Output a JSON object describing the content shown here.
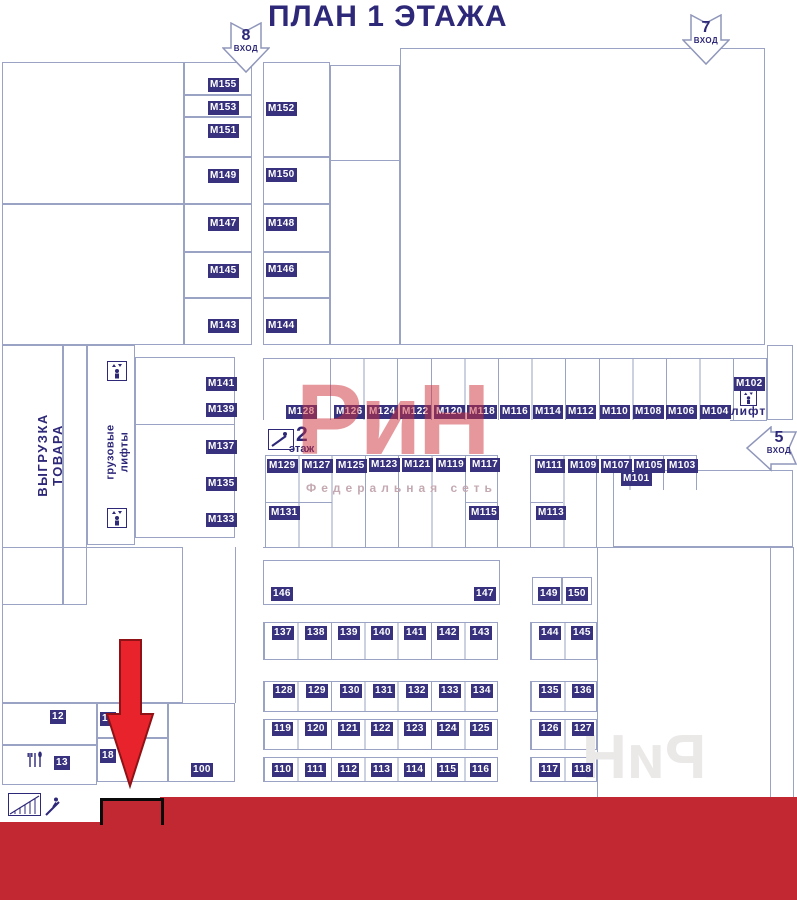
{
  "title": "ПЛАН 1 ЭТАЖА",
  "entrances": {
    "e8": {
      "number": "8",
      "word": "ВХОД"
    },
    "e7": {
      "number": "7",
      "word": "ВХОД"
    },
    "e5": {
      "number": "5",
      "word": "ВХОД"
    }
  },
  "labels": {
    "unloading": "ВЫГРУЗКА ТОВАРА",
    "cargo_lifts": "грузовые\nлифты",
    "lift": "лифт",
    "floor2_number": "2",
    "floor2_word": "этаж"
  },
  "logo": {
    "text": "РиН",
    "subtitle": "Федеральная сеть",
    "watermark": "РиН"
  },
  "colors": {
    "ink": "#2e2878",
    "badge_bg": "#38327e",
    "wall": "#9aa3c4",
    "band_red": "#c22832",
    "arrow_red": "#e8232b",
    "logo_red": "#ce323a"
  },
  "icons": {
    "cargo_lift": "elevator-icon",
    "lift": "elevator-icon",
    "floor2": "escalator-icon",
    "cafe": "cutlery-icon",
    "stairs": "stairs-icon",
    "escalator_person": "escalator-person-icon",
    "red_arrow": "location-arrow"
  },
  "m_units": [
    {
      "label": "М155",
      "x": 208,
      "y": 78
    },
    {
      "label": "М153",
      "x": 208,
      "y": 101
    },
    {
      "label": "М151",
      "x": 208,
      "y": 124
    },
    {
      "label": "М149",
      "x": 208,
      "y": 169
    },
    {
      "label": "М147",
      "x": 208,
      "y": 217
    },
    {
      "label": "М145",
      "x": 208,
      "y": 264
    },
    {
      "label": "М143",
      "x": 208,
      "y": 319
    },
    {
      "label": "М152",
      "x": 266,
      "y": 102
    },
    {
      "label": "М150",
      "x": 266,
      "y": 168
    },
    {
      "label": "М148",
      "x": 266,
      "y": 217
    },
    {
      "label": "М146",
      "x": 266,
      "y": 263
    },
    {
      "label": "М144",
      "x": 266,
      "y": 319
    },
    {
      "label": "М141",
      "x": 206,
      "y": 377
    },
    {
      "label": "М139",
      "x": 206,
      "y": 403
    },
    {
      "label": "М137",
      "x": 206,
      "y": 440
    },
    {
      "label": "М135",
      "x": 206,
      "y": 477
    },
    {
      "label": "М133",
      "x": 206,
      "y": 513
    },
    {
      "label": "М128",
      "x": 286,
      "y": 405
    },
    {
      "label": "М126",
      "x": 334,
      "y": 405
    },
    {
      "label": "М124",
      "x": 367,
      "y": 405
    },
    {
      "label": "М122",
      "x": 400,
      "y": 405
    },
    {
      "label": "М120",
      "x": 434,
      "y": 405
    },
    {
      "label": "М118",
      "x": 467,
      "y": 405
    },
    {
      "label": "М116",
      "x": 500,
      "y": 405
    },
    {
      "label": "М114",
      "x": 533,
      "y": 405
    },
    {
      "label": "М112",
      "x": 566,
      "y": 405
    },
    {
      "label": "М110",
      "x": 600,
      "y": 405
    },
    {
      "label": "М108",
      "x": 633,
      "y": 405
    },
    {
      "label": "М106",
      "x": 666,
      "y": 405
    },
    {
      "label": "М104",
      "x": 700,
      "y": 405
    },
    {
      "label": "М102",
      "x": 734,
      "y": 377
    },
    {
      "label": "М129",
      "x": 267,
      "y": 459
    },
    {
      "label": "М127",
      "x": 302,
      "y": 459
    },
    {
      "label": "М125",
      "x": 336,
      "y": 459
    },
    {
      "label": "М123",
      "x": 369,
      "y": 458
    },
    {
      "label": "М121",
      "x": 402,
      "y": 458
    },
    {
      "label": "М119",
      "x": 436,
      "y": 458
    },
    {
      "label": "М117",
      "x": 470,
      "y": 458
    },
    {
      "label": "М111",
      "x": 535,
      "y": 459
    },
    {
      "label": "М109",
      "x": 568,
      "y": 459
    },
    {
      "label": "М107",
      "x": 601,
      "y": 459
    },
    {
      "label": "М105",
      "x": 634,
      "y": 459
    },
    {
      "label": "М103",
      "x": 667,
      "y": 459
    },
    {
      "label": "М101",
      "x": 621,
      "y": 472
    },
    {
      "label": "М131",
      "x": 269,
      "y": 506
    },
    {
      "label": "М115",
      "x": 469,
      "y": 506
    },
    {
      "label": "М113",
      "x": 536,
      "y": 506
    }
  ],
  "num_units": [
    {
      "label": "146",
      "x": 271,
      "y": 587
    },
    {
      "label": "147",
      "x": 474,
      "y": 587
    },
    {
      "label": "149",
      "x": 538,
      "y": 587
    },
    {
      "label": "150",
      "x": 566,
      "y": 587
    },
    {
      "label": "137",
      "x": 272,
      "y": 626
    },
    {
      "label": "138",
      "x": 305,
      "y": 626
    },
    {
      "label": "139",
      "x": 338,
      "y": 626
    },
    {
      "label": "140",
      "x": 371,
      "y": 626
    },
    {
      "label": "141",
      "x": 404,
      "y": 626
    },
    {
      "label": "142",
      "x": 437,
      "y": 626
    },
    {
      "label": "143",
      "x": 470,
      "y": 626
    },
    {
      "label": "144",
      "x": 539,
      "y": 626
    },
    {
      "label": "145",
      "x": 571,
      "y": 626
    },
    {
      "label": "128",
      "x": 273,
      "y": 684
    },
    {
      "label": "129",
      "x": 306,
      "y": 684
    },
    {
      "label": "130",
      "x": 340,
      "y": 684
    },
    {
      "label": "131",
      "x": 373,
      "y": 684
    },
    {
      "label": "132",
      "x": 406,
      "y": 684
    },
    {
      "label": "133",
      "x": 439,
      "y": 684
    },
    {
      "label": "134",
      "x": 471,
      "y": 684
    },
    {
      "label": "135",
      "x": 539,
      "y": 684
    },
    {
      "label": "136",
      "x": 572,
      "y": 684
    },
    {
      "label": "119",
      "x": 272,
      "y": 722
    },
    {
      "label": "120",
      "x": 305,
      "y": 722
    },
    {
      "label": "121",
      "x": 338,
      "y": 722
    },
    {
      "label": "122",
      "x": 371,
      "y": 722
    },
    {
      "label": "123",
      "x": 404,
      "y": 722
    },
    {
      "label": "124",
      "x": 437,
      "y": 722
    },
    {
      "label": "125",
      "x": 470,
      "y": 722
    },
    {
      "label": "126",
      "x": 539,
      "y": 722
    },
    {
      "label": "127",
      "x": 572,
      "y": 722
    },
    {
      "label": "110",
      "x": 272,
      "y": 763
    },
    {
      "label": "111",
      "x": 305,
      "y": 763
    },
    {
      "label": "112",
      "x": 338,
      "y": 763
    },
    {
      "label": "113",
      "x": 371,
      "y": 763
    },
    {
      "label": "114",
      "x": 404,
      "y": 763
    },
    {
      "label": "115",
      "x": 437,
      "y": 763
    },
    {
      "label": "116",
      "x": 470,
      "y": 763
    },
    {
      "label": "117",
      "x": 539,
      "y": 763
    },
    {
      "label": "118",
      "x": 572,
      "y": 763
    },
    {
      "label": "12",
      "x": 50,
      "y": 710
    },
    {
      "label": "17",
      "x": 100,
      "y": 712
    },
    {
      "label": "13",
      "x": 54,
      "y": 756
    },
    {
      "label": "18",
      "x": 100,
      "y": 749
    },
    {
      "label": "100",
      "x": 191,
      "y": 763
    }
  ]
}
